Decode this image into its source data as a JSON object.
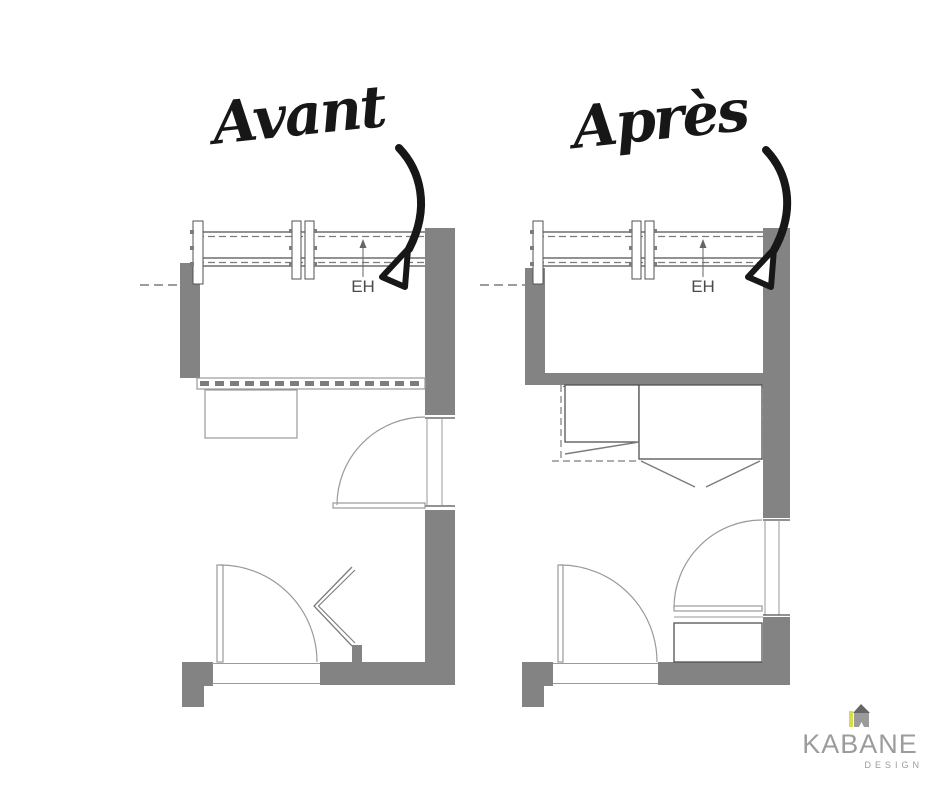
{
  "titles": {
    "before": "Avant",
    "after": "Après"
  },
  "plans": {
    "before": {
      "eh_label": "EH"
    },
    "after": {
      "eh_label": "EH"
    }
  },
  "logo": {
    "brand": "KABANE",
    "tagline": "DESIGN"
  },
  "colors": {
    "background": "#ffffff",
    "ink": "#171717",
    "wall-gray": "#838383",
    "line-dark": "#525252",
    "line-mid": "#7c7c7c",
    "line-light": "#9a9a9a",
    "logo-text": "#9c9c9c",
    "logo-yellow": "#d8dc49",
    "logo-roof": "#666666",
    "logo-body": "#9b9b9b"
  }
}
